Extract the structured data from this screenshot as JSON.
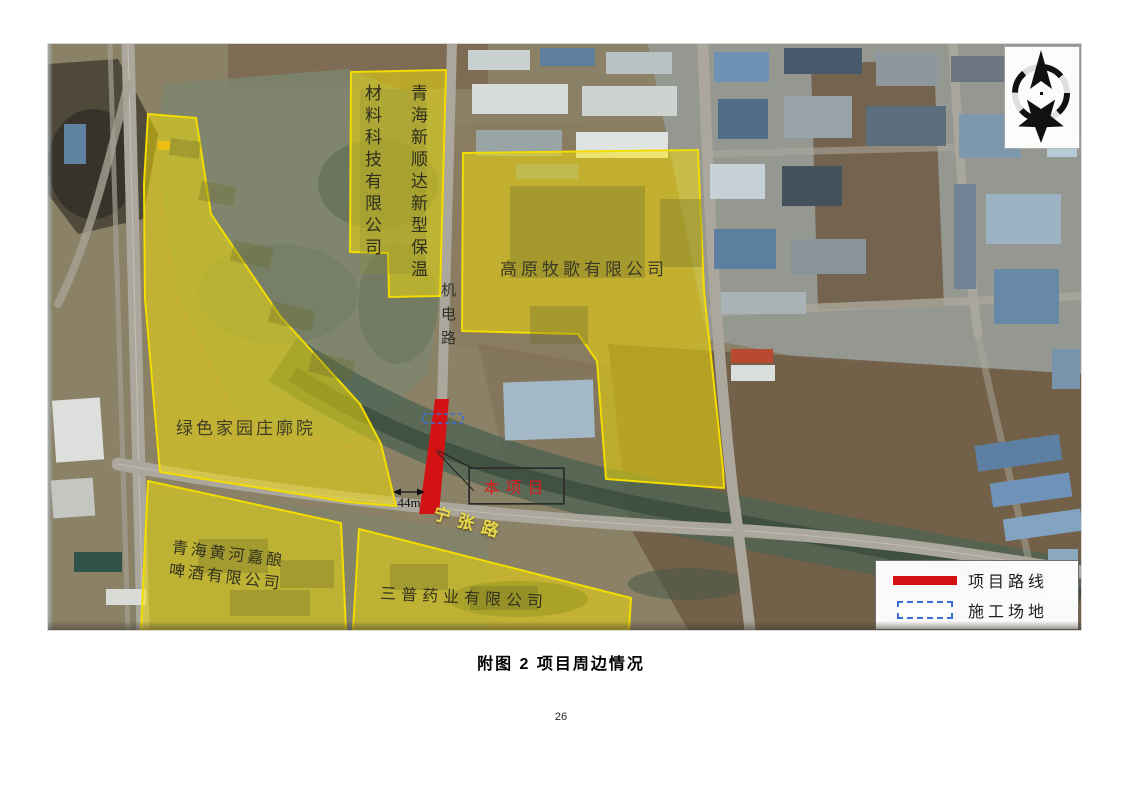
{
  "page": {
    "caption": "附图 2 项目周边情况",
    "page_number": "26"
  },
  "map": {
    "areas": [
      {
        "label": "青海新顺达新型保温材料科技有限公司"
      },
      {
        "label": "高原牧歌有限公司"
      },
      {
        "label": "绿色家园庄廓院"
      },
      {
        "label": "青海黄河嘉酿啤酒有限公司"
      },
      {
        "label": "三普药业有限公司"
      }
    ],
    "roads": [
      {
        "label": "机电路"
      },
      {
        "label": "宁张路"
      }
    ],
    "callout": {
      "project_label": "本项目",
      "road_width_label": "44m"
    },
    "legend": {
      "route_label": "项目路线",
      "site_label": "施工场地"
    },
    "colors": {
      "highlight": "#f2dc00",
      "route": "#d31313",
      "site_outline": "#3a6fd8"
    }
  }
}
